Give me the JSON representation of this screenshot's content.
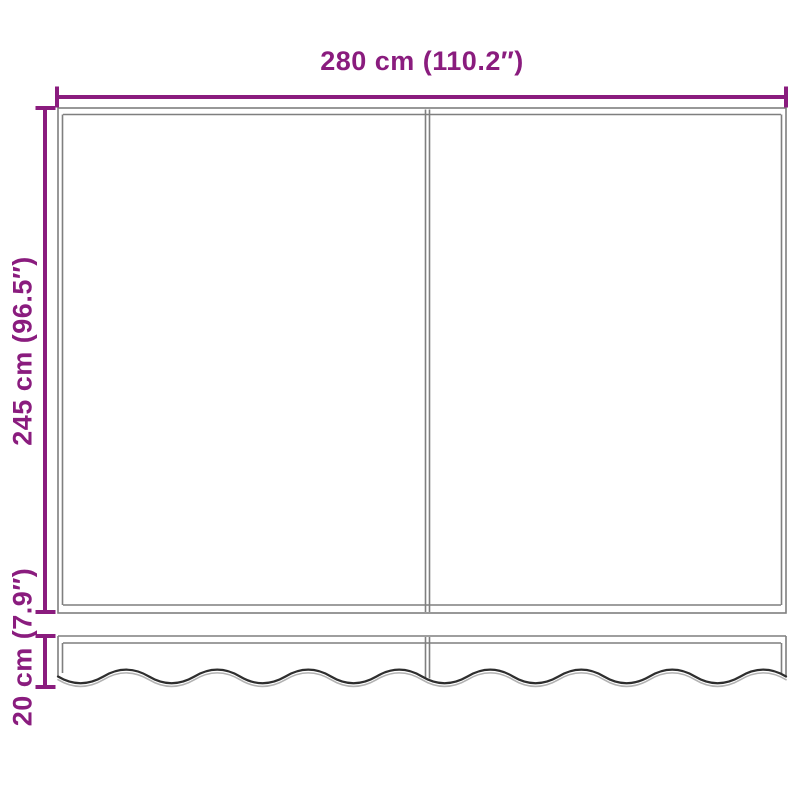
{
  "colors": {
    "accent": "#8A1C7E",
    "frame-line": "#7F7F7F",
    "wave-dark": "#2E2E2E",
    "wave-light": "#B2B2B2",
    "background": "#FFFFFF"
  },
  "diagram": {
    "product": "awning-with-valance-dimension-diagram",
    "dimensions": {
      "width": {
        "label": "280 cm (110.2″)"
      },
      "height": {
        "label": "245 cm (96.5″)"
      },
      "valance_height": {
        "label": "20 cm (7.9″)"
      }
    }
  }
}
